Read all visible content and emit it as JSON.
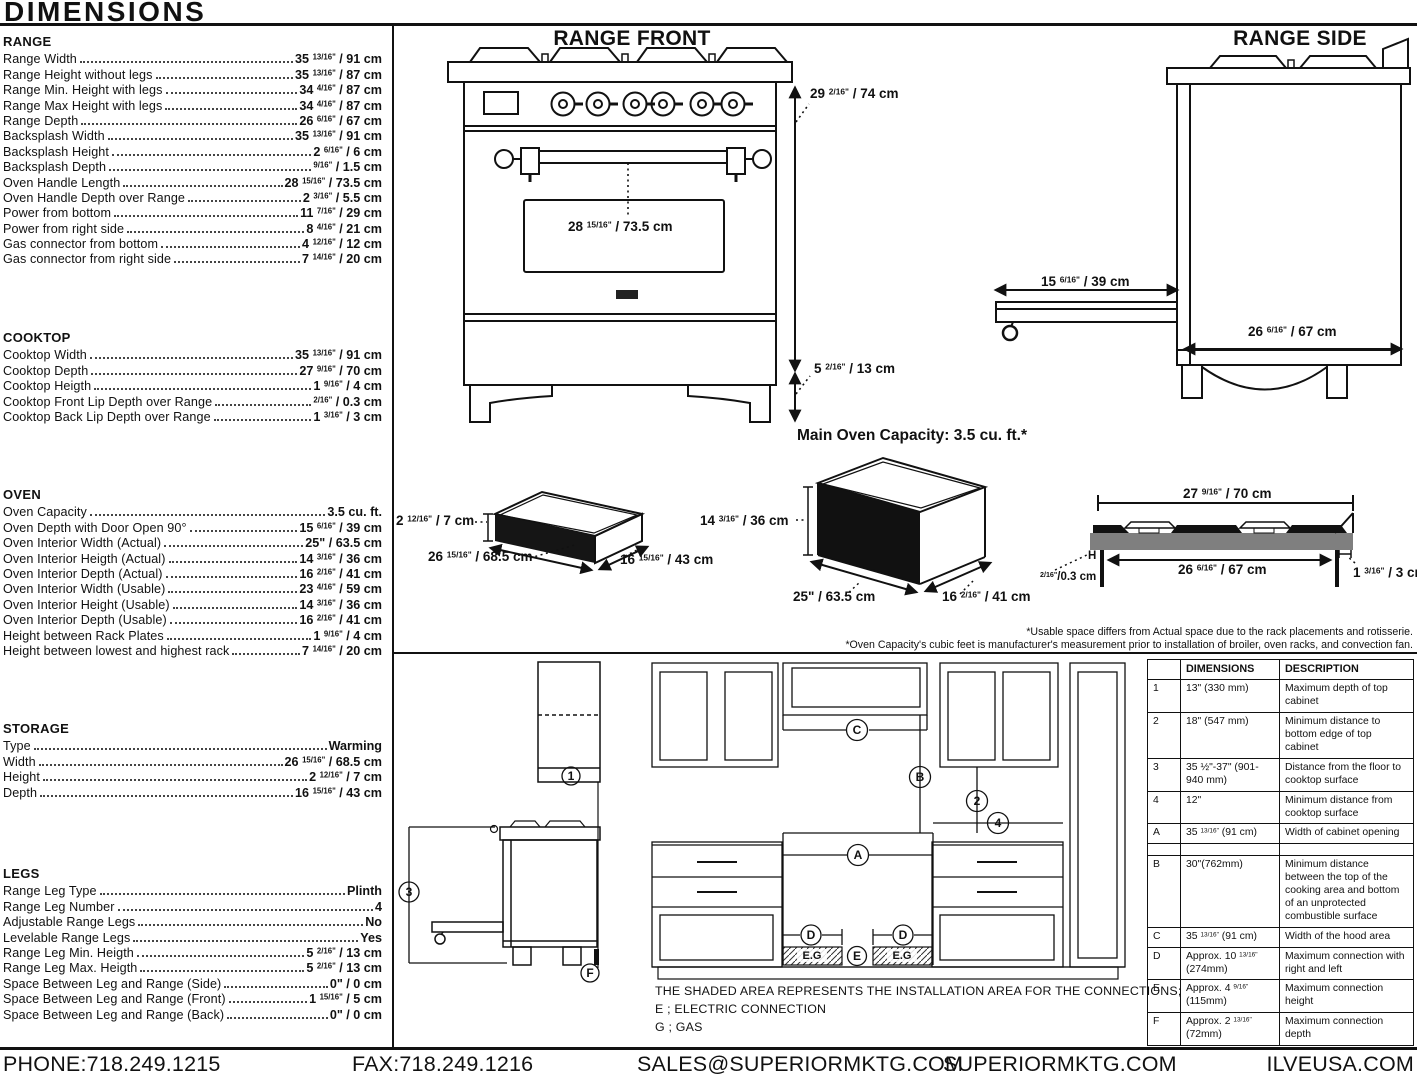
{
  "page_title": "DIMENSIONS",
  "colors": {
    "ink": "#111111",
    "cooktop_gray": "#7f7f7f",
    "fill_black": "#151515"
  },
  "left_panel": {
    "sections": [
      {
        "title": "RANGE",
        "rows": [
          {
            "label": "Range Width",
            "value": "35 13/16\" / 91 cm"
          },
          {
            "label": "Range Height without legs",
            "value": "35 13/16\" / 87 cm"
          },
          {
            "label": "Range Min. Height with legs",
            "value": "34 4/16\" / 87 cm"
          },
          {
            "label": "Range Max Height with legs",
            "value": "34 4/16\" / 87 cm"
          },
          {
            "label": "Range Depth",
            "value": "26 6/16\" / 67 cm"
          },
          {
            "label": "Backsplash Width",
            "value": "35 13/16\" / 91 cm"
          },
          {
            "label": "Backsplash Height",
            "value": "2 6/16\" / 6 cm"
          },
          {
            "label": "Backsplash Depth",
            "value": "9/16\" / 1.5 cm"
          },
          {
            "label": "Oven Handle Length",
            "value": "28 15/16\" / 73.5 cm"
          },
          {
            "label": "Oven Handle Depth over Range",
            "value": "2 3/16\" / 5.5 cm"
          },
          {
            "label": "Power from bottom",
            "value": "11 7/16\" / 29 cm"
          },
          {
            "label": "Power from right side",
            "value": "8 4/16\" / 21 cm"
          },
          {
            "label": "Gas connector from bottom",
            "value": "4 12/16\" / 12 cm"
          },
          {
            "label": "Gas connector from right side",
            "value": "7 14/16\" / 20 cm"
          }
        ]
      },
      {
        "title": "COOKTOP",
        "rows": [
          {
            "label": "Cooktop Width",
            "value": "35 13/16\" / 91 cm"
          },
          {
            "label": "Cooktop Depth",
            "value": "27 9/16\" / 70 cm"
          },
          {
            "label": "Cooktop Heigth",
            "value": "1 9/16\" / 4 cm"
          },
          {
            "label": "Cooktop Front Lip Depth over Range",
            "value": "2/16\" / 0.3 cm"
          },
          {
            "label": "Cooktop Back Lip Depth over Range",
            "value": "1 3/16\" / 3 cm"
          }
        ]
      },
      {
        "title": "OVEN",
        "rows": [
          {
            "label": "Oven Capacity",
            "value": "3.5 cu. ft."
          },
          {
            "label": "Oven Depth with Door Open 90°",
            "value": "15 6/16\" / 39 cm"
          },
          {
            "label": "Oven Interior Width (Actual)",
            "value": "25\" / 63.5 cm"
          },
          {
            "label": "Oven Interior Heigth (Actual)",
            "value": "14 3/16\" / 36 cm"
          },
          {
            "label": "Oven Interior Depth (Actual)",
            "value": "16 2/16\" / 41 cm"
          },
          {
            "label": "Oven Interior Width (Usable)",
            "value": "23 4/16\" / 59 cm"
          },
          {
            "label": "Oven Interior Height (Usable)",
            "value": "14 3/16\" / 36 cm"
          },
          {
            "label": "Oven Interior Depth (Usable)",
            "value": "16 2/16\" / 41 cm"
          },
          {
            "label": "Height between Rack Plates",
            "value": "1 9/16\" / 4 cm"
          },
          {
            "label": "Height between lowest and highest rack",
            "value": "7 14/16\" / 20 cm"
          }
        ]
      },
      {
        "title": "STORAGE",
        "rows": [
          {
            "label": "Type",
            "value": "Warming"
          },
          {
            "label": "Width",
            "value": "26 15/16\" / 68.5 cm"
          },
          {
            "label": "Height",
            "value": "2 12/16\" / 7 cm"
          },
          {
            "label": "Depth",
            "value": "16 15/16\" / 43 cm"
          }
        ]
      },
      {
        "title": "LEGS",
        "rows": [
          {
            "label": "Range Leg Type",
            "value": "Plinth"
          },
          {
            "label": "Range Leg Number",
            "value": "4"
          },
          {
            "label": "Adjustable Range Legs",
            "value": "No"
          },
          {
            "label": "Levelable Range Legs",
            "value": "Yes"
          },
          {
            "label": "Range Leg Min. Heigth",
            "value": "5 2/16\" / 13 cm"
          },
          {
            "label": "Range Leg Max. Heigth",
            "value": "5 2/16\" / 13 cm"
          },
          {
            "label": "Space Between Leg and Range (Side)",
            "value": "0\" / 0 cm"
          },
          {
            "label": "Space Between Leg and Range (Front)",
            "value": "1 15/16\" / 5 cm"
          },
          {
            "label": "Space Between Leg and Range (Back)",
            "value": "0\" / 0 cm"
          }
        ]
      }
    ]
  },
  "diagrams": {
    "range_front": {
      "title": "RANGE FRONT",
      "overall_height": "29 2/16\" / 74 cm",
      "handle_length": "28 15/16\" / 73.5 cm",
      "leg_height": "5 2/16\" / 13 cm"
    },
    "range_side": {
      "title": "RANGE SIDE",
      "door_open_depth": "15 6/16\" / 39 cm",
      "range_depth": "26 6/16\" / 67 cm"
    },
    "storage_drawer": {
      "height": "2 12/16\" / 7 cm",
      "width": "26 15/16\" / 68.5 cm",
      "depth": "16 15/16\" / 43 cm"
    },
    "main_oven": {
      "title": "Main Oven Capacity: 3.5 cu. ft.*",
      "height": "14 3/16\" / 36 cm",
      "width": "25\" / 63.5 cm",
      "depth": "16 2/16\" / 41 cm"
    },
    "cooktop_profile": {
      "top_width": "27 9/16\" / 70 cm",
      "bottom_width": "26 6/16\" / 67 cm",
      "back_lip": "1 3/16\" / 3 cm",
      "front_lip": "2/16\"/0.3 cm",
      "h_mark": "H"
    },
    "footnote1": "*Usable space differs from Actual space due to the rack placements and rotisserie.",
    "footnote2": "*Oven Capacity's cubic feet is manufacturer's measurement prior to installation of broiler, oven racks, and convection fan."
  },
  "installation": {
    "note_title": "THE SHADED AREA REPRESENTS THE INSTALLATION AREA FOR THE CONNECTIONS;",
    "legend_electric": "E ; ELECTRIC CONNECTION",
    "legend_gas": "G ; GAS",
    "eg_label": "E.G",
    "marks": {
      "n1": "1",
      "n2": "2",
      "n3": "3",
      "n4": "4",
      "a": "A",
      "b": "B",
      "c": "C",
      "d": "D",
      "e": "E",
      "f": "F"
    },
    "table": {
      "headers": [
        "",
        "DIMENSIONS",
        "DESCRIPTION"
      ],
      "rows": [
        {
          "id": "1",
          "dim": "13\" (330 mm)",
          "desc": "Maximum depth of top cabinet"
        },
        {
          "id": "2",
          "dim": "18\" (547 mm)",
          "desc": "Minimum distance to bottom edge of top cabinet"
        },
        {
          "id": "3",
          "dim": "35 ½\"-37\" (901-940 mm)",
          "desc": "Distance from the floor to cooktop surface"
        },
        {
          "id": "4",
          "dim": "12\"",
          "desc": "Minimum distance from cooktop surface"
        },
        {
          "id": "A",
          "dim": "35 13/16\" (91 cm)",
          "desc": "Width of cabinet opening"
        },
        {
          "id": "",
          "dim": "",
          "desc": "",
          "spacer": true
        },
        {
          "id": "B",
          "dim": "30\"(762mm)",
          "desc": "Minimum distance between the top of the cooking area and bottom of an unprotected combustible surface"
        },
        {
          "id": "C",
          "dim": "35 13/16\" (91 cm)",
          "desc": "Width of the hood area"
        },
        {
          "id": "D",
          "dim": "Approx. 10 13/16\" (274mm)",
          "desc": "Maximum connection with right and left"
        },
        {
          "id": "E",
          "dim": "Approx. 4 9/16\" (115mm)",
          "desc": "Maximum connection height"
        },
        {
          "id": "F",
          "dim": "Approx. 2 13/16\" (72mm)",
          "desc": "Maximum connection depth"
        }
      ]
    }
  },
  "footer": {
    "phone": "PHONE:718.249.1215",
    "fax": "FAX:718.249.1216",
    "email": "SALES@SUPERIORMKTG.COM",
    "website": "SUPERIORMKTG.COM",
    "brand_site": "ILVEUSA.COM"
  }
}
